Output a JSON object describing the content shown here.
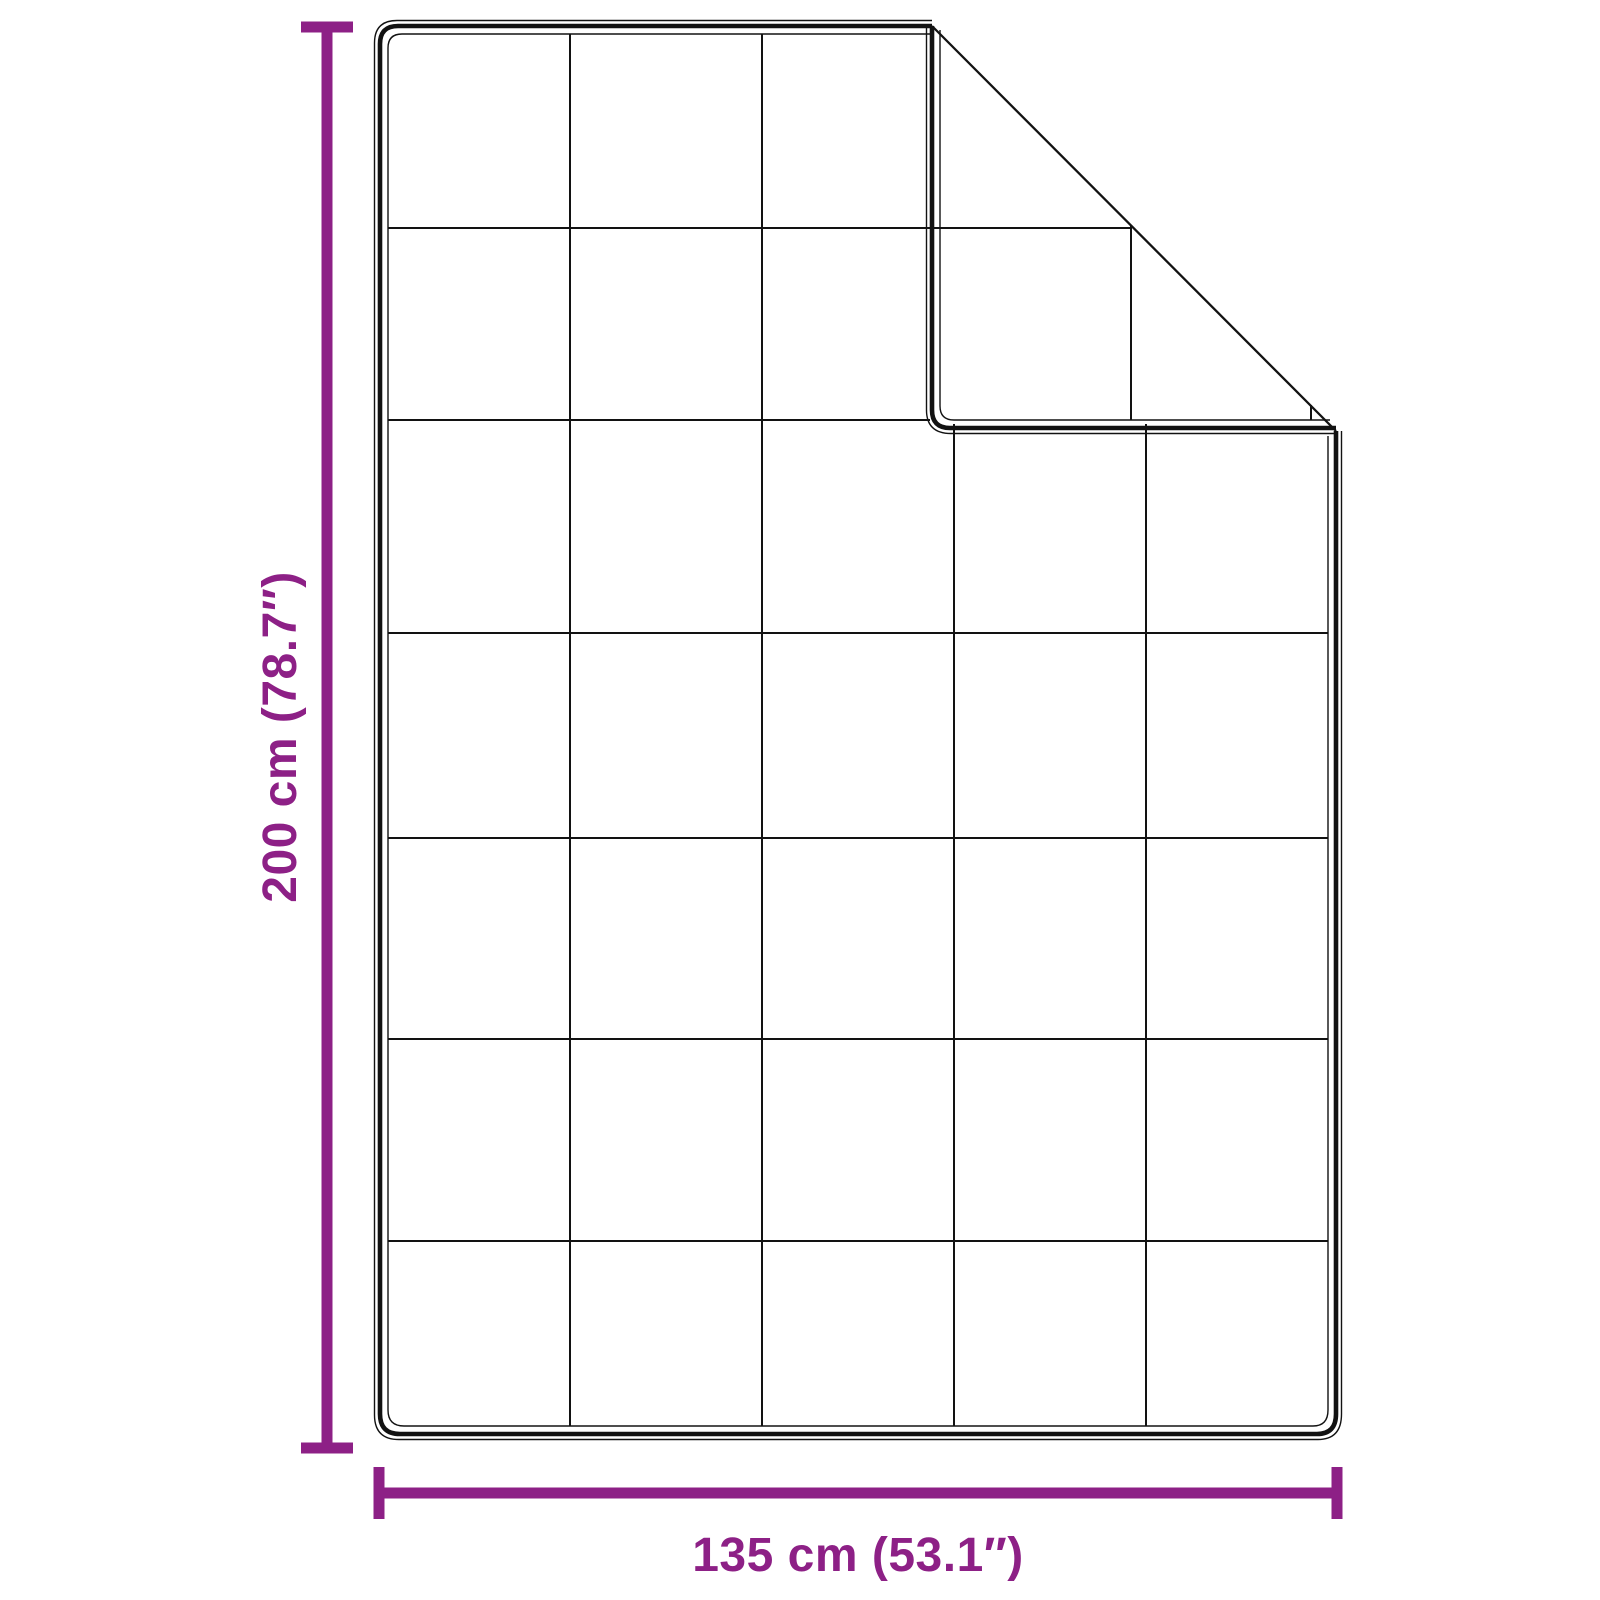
{
  "colors": {
    "accent": "#8d2086",
    "line": "#121212",
    "background": "#ffffff"
  },
  "diagram": {
    "description": "Quilted blanket shown flat with top-right corner folded over, annotated with dimension lines",
    "grid": {
      "columns": 5,
      "rows": 7
    },
    "height_label": "200 cm (78.7″)",
    "width_label": "135 cm (53.1″)"
  }
}
